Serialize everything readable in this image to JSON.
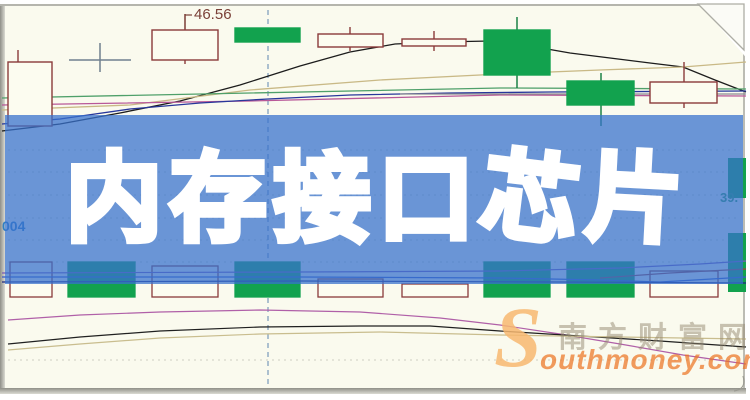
{
  "banner": {
    "title": "内存接口芯片",
    "chars": [
      "内",
      "存",
      "接",
      "口",
      "芯",
      "片"
    ],
    "bg_color_rgba": "rgba(55,114,205,0.74)",
    "text_color": "#ffffff"
  },
  "watermark": {
    "s": "S",
    "cn": "南方财富网",
    "en": "outhmoney.com"
  },
  "chart_data": {
    "type": "candlestick",
    "units": "px",
    "title": "",
    "annotations": {
      "price_label": "46.56",
      "left_axis_label": "004",
      "right_axis_label": "39."
    },
    "colors": {
      "background": "#fafaee",
      "candle_outline": "#8a3a3a",
      "candle_hollow_fill": "#fcfcf0",
      "candle_green": "#12a24e",
      "doji": "#70808f",
      "grid": "rgba(125,125,112,0.35)",
      "dashed_line": "#5d87b0",
      "label_price": "#7a4038",
      "label_left": "#2f7fc4",
      "label_right": "#2f9f5f"
    },
    "dashed_x": 268,
    "gridlines_y": [
      150,
      172,
      195,
      218,
      240,
      262,
      360
    ],
    "candles": [
      {
        "x": 8,
        "w": 44,
        "top": 62,
        "bottom": 126,
        "kind": "hollow",
        "wick": {
          "cx": 18,
          "t": 50,
          "b": 126
        }
      },
      {
        "x": 152,
        "w": 66,
        "top": 30,
        "bottom": 60,
        "kind": "hollow",
        "wick": {
          "cx": 185,
          "t": 14,
          "b": 64
        }
      },
      {
        "x": 235,
        "w": 65,
        "top": 28,
        "bottom": 42,
        "kind": "green"
      },
      {
        "x": 318,
        "w": 65,
        "top": 34,
        "bottom": 47,
        "kind": "hollow",
        "wick": {
          "cx": 350,
          "t": 27,
          "b": 51
        }
      },
      {
        "x": 402,
        "w": 64,
        "top": 39,
        "bottom": 46,
        "kind": "hollow",
        "wick": {
          "cx": 434,
          "t": 31,
          "b": 51
        }
      },
      {
        "x": 484,
        "w": 66,
        "top": 30,
        "bottom": 75,
        "kind": "green",
        "wick": {
          "cx": 517,
          "t": 17,
          "b": 88
        }
      },
      {
        "x": 567,
        "w": 67,
        "top": 81,
        "bottom": 105,
        "kind": "green",
        "wick": {
          "cx": 601,
          "t": 73,
          "b": 126
        }
      },
      {
        "x": 650,
        "w": 67,
        "top": 82,
        "bottom": 103,
        "kind": "hollow",
        "wick": {
          "cx": 684,
          "t": 62,
          "b": 108
        }
      }
    ],
    "doji": {
      "cx": 100,
      "y": 60,
      "half": 31,
      "wick_top": 43,
      "wick_bottom": 72
    },
    "price_pointer": {
      "x": 185,
      "y1": 14,
      "y2": 29,
      "tx": 194,
      "ty": 19
    },
    "ma_top": [
      {
        "name": "ma-black",
        "color": "#1c1c1c",
        "points": [
          [
            2,
            131
          ],
          [
            60,
            124
          ],
          [
            120,
            113
          ],
          [
            180,
            101
          ],
          [
            240,
            85
          ],
          [
            300,
            66
          ],
          [
            350,
            52
          ],
          [
            395,
            44
          ],
          [
            440,
            42
          ],
          [
            490,
            41
          ],
          [
            530,
            46
          ],
          [
            570,
            53
          ],
          [
            610,
            58
          ],
          [
            650,
            63
          ],
          [
            683,
            67
          ],
          [
            715,
            80
          ],
          [
            746,
            92
          ]
        ]
      },
      {
        "name": "ma-tan",
        "color": "#c9b986",
        "points": [
          [
            2,
            110
          ],
          [
            130,
            105
          ],
          [
            250,
            90
          ],
          [
            380,
            80
          ],
          [
            500,
            74
          ],
          [
            600,
            70
          ],
          [
            683,
            67
          ],
          [
            746,
            62
          ]
        ]
      },
      {
        "name": "ma-teal",
        "color": "#4fa06a",
        "points": [
          [
            2,
            98
          ],
          [
            250,
            93
          ],
          [
            500,
            88
          ],
          [
            746,
            89
          ]
        ]
      },
      {
        "name": "ma-magenta",
        "color": "#b85898",
        "points": [
          [
            2,
            105
          ],
          [
            250,
            101
          ],
          [
            500,
            95
          ],
          [
            746,
            96
          ]
        ]
      },
      {
        "name": "ma-navy",
        "color": "#27379b",
        "points": [
          [
            2,
            124
          ],
          [
            60,
            119
          ],
          [
            130,
            109
          ],
          [
            200,
            103
          ],
          [
            268,
            99
          ],
          [
            350,
            95
          ],
          [
            450,
            93
          ],
          [
            550,
            92
          ],
          [
            746,
            91
          ]
        ]
      },
      {
        "name": "ma-gray",
        "color": "#8a8a92",
        "points": [
          [
            400,
            94
          ],
          [
            746,
            94
          ]
        ]
      }
    ],
    "volume_bars": [
      {
        "x": 10,
        "w": 42,
        "top": 262,
        "kind": "hollow"
      },
      {
        "x": 68,
        "w": 67,
        "top": 262,
        "kind": "green"
      },
      {
        "x": 152,
        "w": 66,
        "top": 266,
        "kind": "hollow"
      },
      {
        "x": 235,
        "w": 65,
        "top": 262,
        "kind": "green"
      },
      {
        "x": 318,
        "w": 65,
        "top": 279,
        "kind": "hollow"
      },
      {
        "x": 402,
        "w": 66,
        "top": 284,
        "kind": "hollow"
      },
      {
        "x": 484,
        "w": 66,
        "top": 262,
        "kind": "green"
      },
      {
        "x": 567,
        "w": 67,
        "top": 262,
        "kind": "green"
      },
      {
        "x": 650,
        "w": 68,
        "top": 271,
        "kind": "hollow"
      }
    ],
    "volume_baseline": 297,
    "right_edge_bars": [
      {
        "x": 728,
        "w": 18,
        "y": 158,
        "h": 40
      },
      {
        "x": 728,
        "w": 18,
        "y": 233,
        "h": 59
      }
    ],
    "volume_ma": [
      {
        "name": "vol-purple",
        "color": "#7a5ab8",
        "points": [
          [
            2,
            273
          ],
          [
            300,
            272
          ],
          [
            500,
            271
          ],
          [
            620,
            268
          ],
          [
            700,
            264
          ],
          [
            746,
            261
          ]
        ]
      },
      {
        "name": "vol-blue",
        "color": "#3858c8",
        "points": [
          [
            2,
            277
          ],
          [
            300,
            277
          ],
          [
            500,
            278
          ],
          [
            600,
            280
          ],
          [
            660,
            282
          ],
          [
            746,
            277
          ]
        ]
      },
      {
        "name": "vol-navy",
        "color": "#202a80",
        "points": [
          [
            2,
            282
          ],
          [
            300,
            281
          ],
          [
            560,
            282
          ],
          [
            746,
            283
          ]
        ]
      },
      {
        "name": "vol-red",
        "color": "#a04040",
        "points": [
          [
            600,
            278
          ],
          [
            670,
            273
          ],
          [
            746,
            269
          ]
        ]
      }
    ],
    "indicator_lines": [
      {
        "name": "ind-magenta",
        "color": "#b060a8",
        "points": [
          [
            8,
            320
          ],
          [
            80,
            315
          ],
          [
            160,
            312
          ],
          [
            260,
            310
          ],
          [
            360,
            312
          ],
          [
            440,
            318
          ],
          [
            500,
            325
          ],
          [
            560,
            334
          ],
          [
            620,
            344
          ],
          [
            683,
            355
          ],
          [
            746,
            364
          ]
        ]
      },
      {
        "name": "ind-black",
        "color": "#202020",
        "points": [
          [
            8,
            344
          ],
          [
            80,
            337
          ],
          [
            160,
            331
          ],
          [
            260,
            327
          ],
          [
            360,
            326
          ],
          [
            430,
            326
          ],
          [
            500,
            331
          ],
          [
            580,
            336
          ],
          [
            660,
            341
          ],
          [
            746,
            347
          ]
        ]
      },
      {
        "name": "ind-tan",
        "color": "#c9bd8e",
        "points": [
          [
            8,
            350
          ],
          [
            80,
            344
          ],
          [
            160,
            338
          ],
          [
            260,
            334
          ],
          [
            380,
            332
          ],
          [
            500,
            335
          ],
          [
            620,
            337
          ],
          [
            746,
            339
          ]
        ]
      }
    ]
  }
}
